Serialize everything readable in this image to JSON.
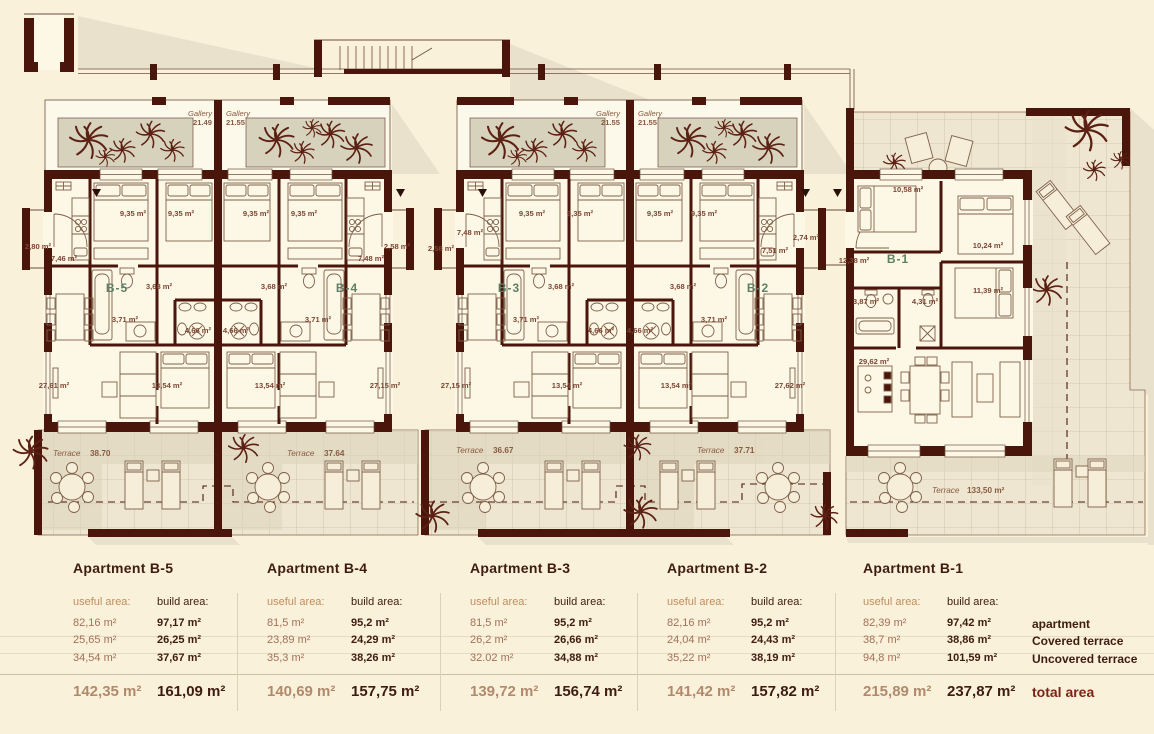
{
  "plan": {
    "unit_labels": [
      "B-5",
      "B-4",
      "B-3",
      "B-2",
      "B-1"
    ],
    "galleries": [
      {
        "name": "Gallery",
        "area": "21.49"
      },
      {
        "name": "Gallery",
        "area": "21.55"
      },
      {
        "name": "Gallery",
        "area": "21.55"
      },
      {
        "name": "Gallery",
        "area": "21.55"
      }
    ],
    "terraces": [
      {
        "name": "Terrace",
        "area": "38.70"
      },
      {
        "name": "Terrace",
        "area": "37.64"
      },
      {
        "name": "Terrace",
        "area": "36.67"
      },
      {
        "name": "Terrace",
        "area": "37.71"
      },
      {
        "name": "Terrace",
        "area": "133,50 m²"
      }
    ],
    "rooms": [
      "2,80 m²",
      "7,46 m²",
      "9,35 m²",
      "9,35 m²",
      "9,35 m²",
      "9,35 m²",
      "7,48 m²",
      "2,58 m²",
      "3,68 m²",
      "3,68 m²",
      "3,71 m²",
      "3,71 m²",
      "4,66 m²",
      "4,66 m²",
      "27,61 m²",
      "13,54 m²",
      "13,54 m²",
      "27,15 m²",
      "2,58 m²",
      "7,48 m²",
      "9,35 m²",
      "9,35 m²",
      "9,35 m²",
      "9,35 m²",
      "7,51 m²",
      "2,74 m²",
      "3,68 m²",
      "3,68 m²",
      "3,71 m²",
      "3,71 m²",
      "4,66 m²",
      "4,66 m²",
      "27,15 m²",
      "13,54 m²",
      "13,54 m²",
      "27,62 m²",
      "10,58 m²",
      "10,24 m²",
      "12,38 m²",
      "3,87 m²",
      "4,31 m²",
      "11,39 m²",
      "29,62 m²"
    ]
  },
  "table": {
    "useful_header": "useful area:",
    "build_header": "build area:",
    "row_labels": [
      "apartment",
      "Covered terrace",
      "Uncovered terrace"
    ],
    "total_label": "total area",
    "apartments": [
      {
        "name": "Apartment B-5",
        "useful": [
          "82,16 m²",
          "25,65 m²",
          "34,54 m²"
        ],
        "build": [
          "97,17 m²",
          "26,25 m²",
          "37,67 m²"
        ],
        "useful_total": "142,35 m²",
        "build_total": "161,09 m²"
      },
      {
        "name": "Apartment B-4",
        "useful": [
          "81,5 m²",
          "23,89 m²",
          "35,3 m²"
        ],
        "build": [
          "95,2 m²",
          "24,29 m²",
          "38,26 m²"
        ],
        "useful_total": "140,69 m²",
        "build_total": "157,75 m²"
      },
      {
        "name": "Apartment B-3",
        "useful": [
          "81,5 m²",
          "26,2 m²",
          "32.02 m²"
        ],
        "build": [
          "95,2 m²",
          "26,66 m²",
          "34,88 m²"
        ],
        "useful_total": "139,72 m²",
        "build_total": "156,74 m²"
      },
      {
        "name": "Apartment B-2",
        "useful": [
          "82,16 m²",
          "24,04 m²",
          "35,22 m²"
        ],
        "build": [
          "95,2 m²",
          "24,43 m²",
          "38,19 m²"
        ],
        "useful_total": "141,42 m²",
        "build_total": "157,82 m²"
      },
      {
        "name": "Apartment B-1",
        "useful": [
          "82,39 m²",
          "38,7 m²",
          "94,8 m²"
        ],
        "build": [
          "97,42 m²",
          "38,86 m²",
          "101,59 m²"
        ],
        "useful_total": "215,89 m²",
        "build_total": "237,87 m²"
      }
    ]
  }
}
